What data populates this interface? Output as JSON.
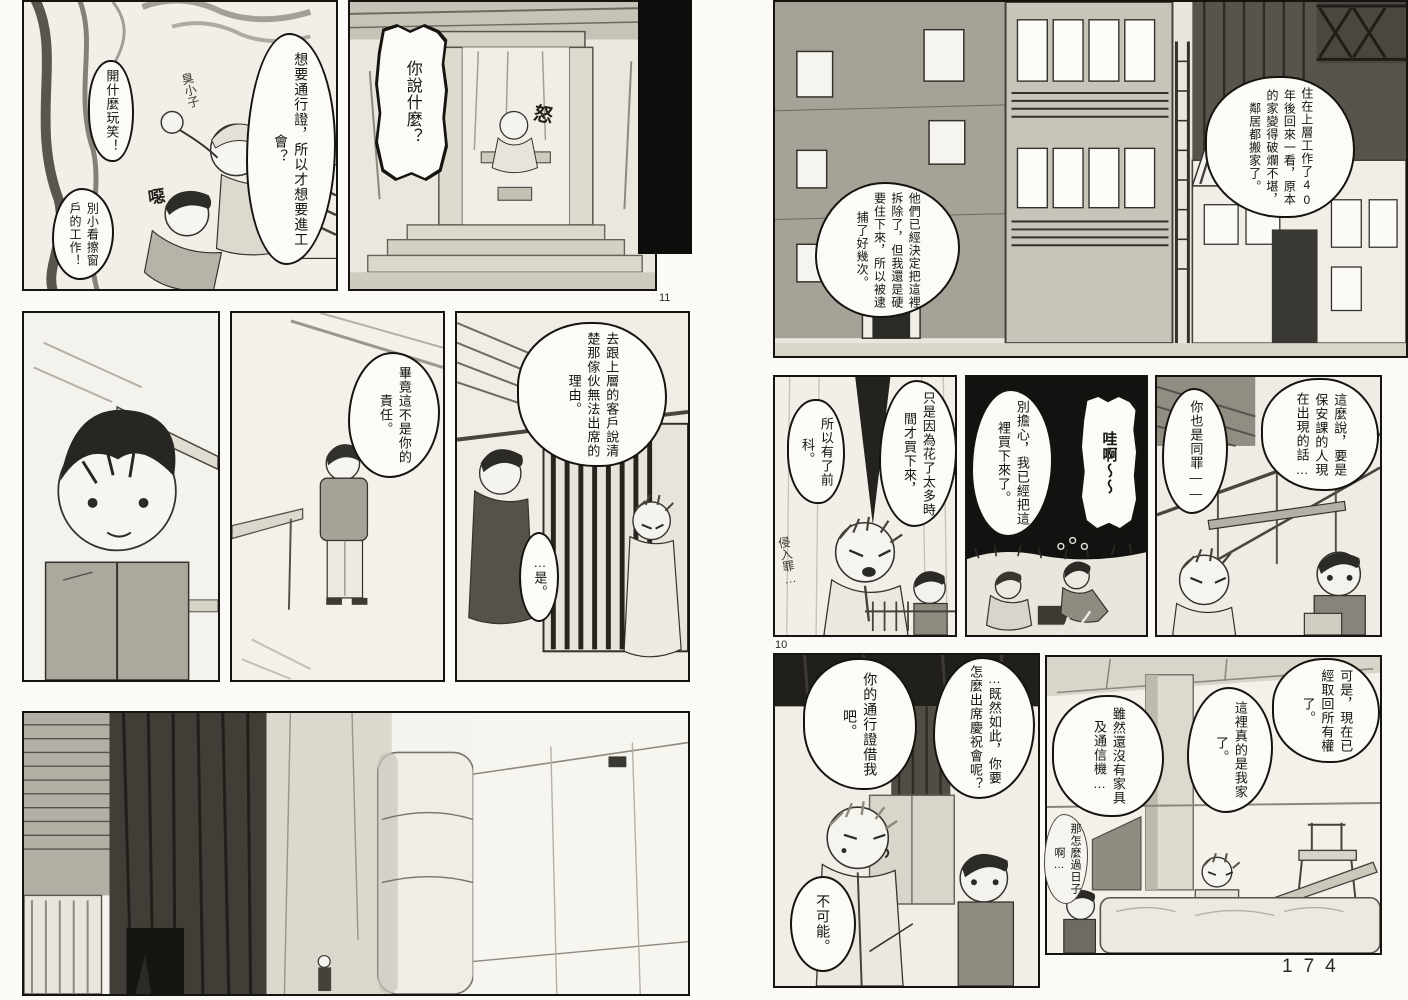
{
  "page_numbers": {
    "printed": "174",
    "panel_marker_left": "11",
    "panel_marker_right": "10"
  },
  "left_page": {
    "fight_panel": {
      "pass": "想要通行證，所以才想要進工會？",
      "kidding": "開什麼玩笑！",
      "brat": "臭小子",
      "sfx_grunt": "噁",
      "window": "別小看擦窗戶的工作！"
    },
    "doorway_panel": {
      "what": "你說什麼？",
      "sfx_anger": "怒"
    },
    "responsibility_panel": {
      "line": "畢竟這不是你的責任。"
    },
    "jail_panel": {
      "explain": "去跟上層的客戶說清楚那傢伙無法出席的理由。",
      "yes": "…是。"
    }
  },
  "right_page": {
    "street_panel": {
      "demolish": "他們已經決定把這裡拆除了，但我還是硬要住下來，所以被逮捕了好幾次。",
      "forty_years": "住在上層工作了40年後回來一看，原本的家變得破爛不堪，鄰居都搬家了。"
    },
    "record_panel": {
      "record": "所以有了前科。",
      "time": "只是因為花了太多時間才買下來，",
      "trespass": "侵入罪…"
    },
    "bought_panel": {
      "dont_worry": "別擔心，我已經把這裡買下來了。",
      "wow": "哇啊～～"
    },
    "security_panel": {
      "security": "這麼說，要是保安課的人現在出現的話…",
      "guilty": "你也是同罪——"
    },
    "permit_panel": {
      "how_attend": "…既然如此，你要怎麼出席慶祝會呢？",
      "lend": "你的通行證借我吧。",
      "no_way": "不可能。"
    },
    "home_panel": {
      "ownership": "可是，現在已經取回所有權了。",
      "my_home": "這裡真的是我家了。",
      "furniture": "雖然還沒有家具及通信機…",
      "how_live": "那怎麼過日子啊…"
    }
  }
}
